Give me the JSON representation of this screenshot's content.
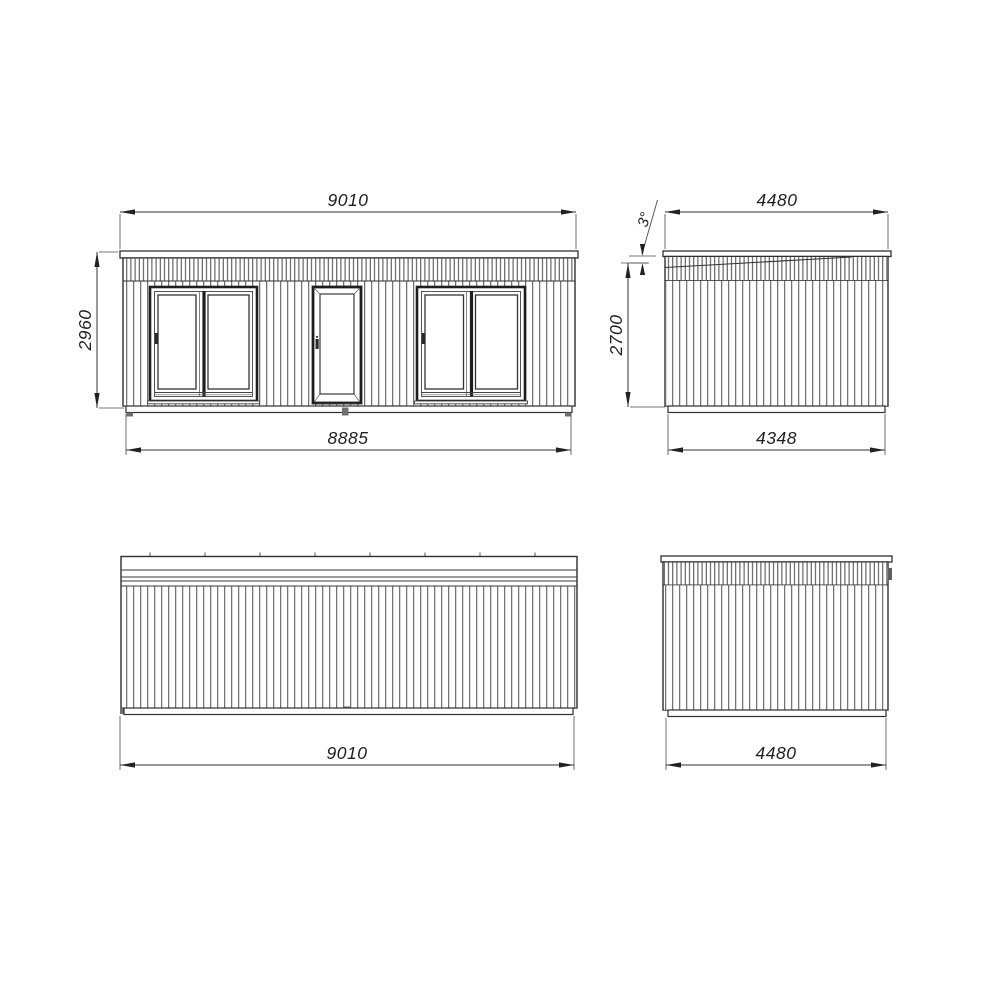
{
  "drawing": {
    "colors": {
      "line": "#2f2f2f",
      "stripe": "#555555",
      "background": "#ffffff",
      "text": "#1f1f1f"
    },
    "views": {
      "front": {
        "dim_width_top": "9010",
        "dim_height": "2960",
        "dim_width_bottom": "8885"
      },
      "side_right": {
        "dim_width_top": "4480",
        "roof_angle": "3°",
        "dim_height": "2700",
        "dim_width_bottom": "4348"
      },
      "rear": {
        "dim_width_bottom": "9010"
      },
      "side_left": {
        "dim_width_bottom": "4480"
      }
    }
  }
}
